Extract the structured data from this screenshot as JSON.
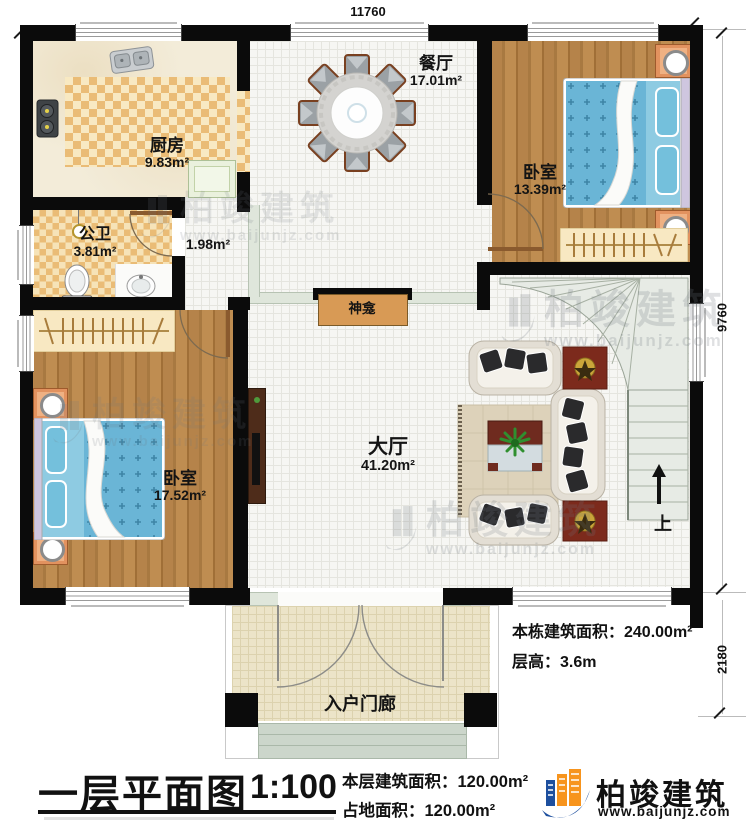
{
  "dims": {
    "top": "11760",
    "right_upper": "9760",
    "right_lower": "2180"
  },
  "rooms": {
    "kitchen": {
      "name": "厨房",
      "area": "9.83m²"
    },
    "dining": {
      "name": "餐厅",
      "area": "17.01m²"
    },
    "bedroom_right": {
      "name": "卧室",
      "area": "13.39m²"
    },
    "bathroom": {
      "name": "公卫",
      "area": "3.81m²"
    },
    "hallway": {
      "area": "1.98m²"
    },
    "bedroom_left": {
      "name": "卧室",
      "area": "17.52m²"
    },
    "living": {
      "name": "大厅",
      "area": "41.20m²"
    },
    "porch": {
      "name": "入户门廊"
    }
  },
  "features": {
    "shrine": "神龛",
    "stairs_up": "上"
  },
  "title": {
    "name": "一层平面图",
    "scale": "1:100"
  },
  "stats": {
    "total": "本栋建筑面积：240.00m²",
    "height": "层高：3.6m",
    "floor": "本层建筑面积：120.00m²",
    "land": "占地面积：120.00m²"
  },
  "brand": {
    "name": "柏竣建筑",
    "url": "www.baijunjz.com"
  },
  "watermark": {
    "name": "柏竣建筑",
    "url": "www.baijunjz.com"
  },
  "colors": {
    "wall": "#0b0b0b",
    "wood": "#b5834a",
    "mattress": "#6ab5d6",
    "checker": "#eabc76",
    "shrine": "#d89a55",
    "sage_beam": "#dfe6db",
    "logo_blue": "#1d4f9e",
    "logo_orange": "#f7941d"
  }
}
